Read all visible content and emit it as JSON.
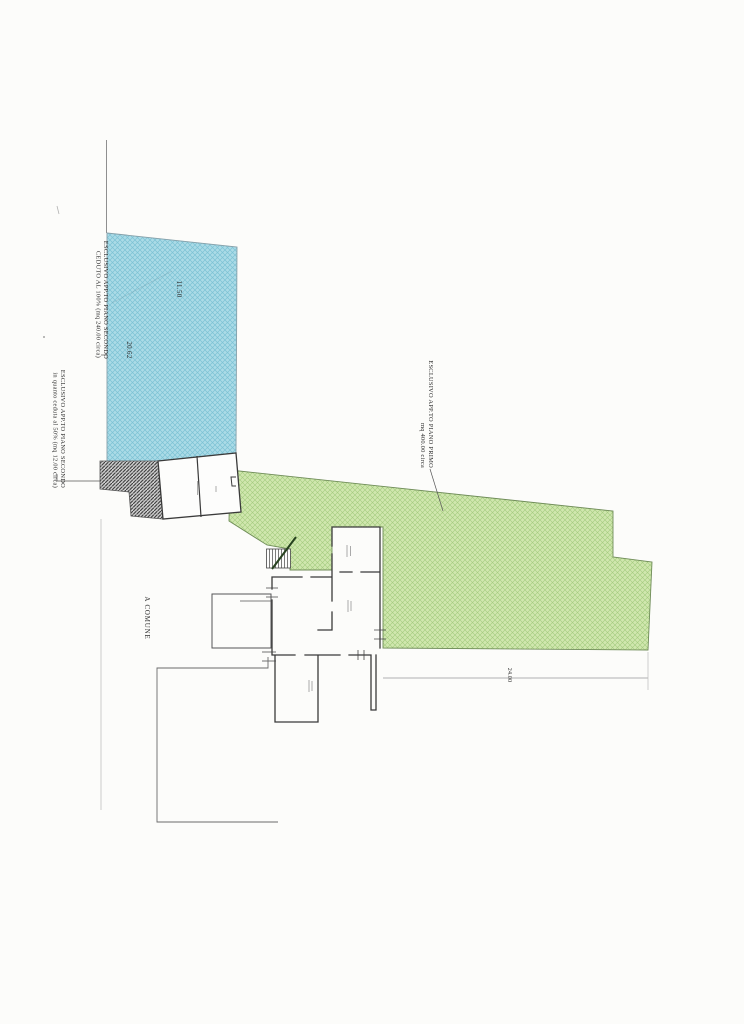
{
  "document": {
    "labels": {
      "second_floor_sold": {
        "line1": "ESCLUSIVO APP.TO PIANO SECONDO",
        "line2": "CEDUTO AL 100%  (mq 240.00 circa)"
      },
      "second_floor_half": {
        "line1": "ESCLUSIVO APP.TO PIANO SECONDO",
        "line2": "in quanto ceduta al 50% (mq 12.00 circa)"
      },
      "first_floor": {
        "line1": "ESCLUSIVO APP.TO PIANO PRIMO",
        "line2": "mq 400.00 circa"
      },
      "common_area": "A COMUNE",
      "dim_top": "11.50",
      "dim_left": "20.62",
      "dim_bottom": "24.00"
    },
    "colors": {
      "blue_fill": "#abdbe7",
      "blue_hatch": "#7cc2d4",
      "blue_edge": "#85a0aa",
      "green_fill": "#d0e7ae",
      "green_hatch": "#a3cb7e",
      "green_edge": "#6f8c58",
      "gray_hatch_bg": "#cccccc",
      "gray_hatch_line": "#3d3d3d",
      "wall": "#3a3a3a",
      "boundary": "#8f8f8f",
      "text": "#2f2f2f"
    }
  }
}
